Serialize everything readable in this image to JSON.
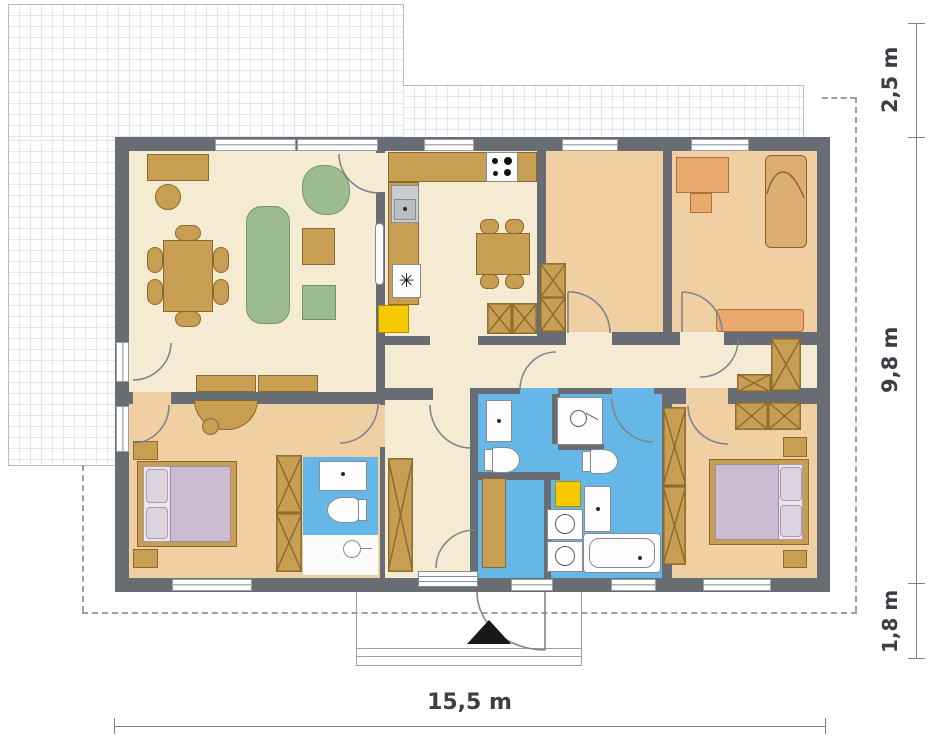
{
  "dimension_labels": {
    "right_top": "2,5 m",
    "right_mid": "9,8 m",
    "right_bottom": "1,8 m",
    "bottom_width": "15,5 m"
  },
  "symbols": {
    "freezer": "✳"
  },
  "palette": {
    "wall": "#686c73",
    "floor_main": "#f4ebd2",
    "floor_bedroom": "#f0cfa2",
    "floor_bath": "#64b7e6",
    "furniture_wood": "#c79e52",
    "sofa_green": "#9cbb90",
    "bed_purple": "#cbbcd3",
    "desk_orange": "#eaa96e",
    "boiler_yellow": "#f6c800",
    "terrace_grid": "#e3e6ec",
    "boundary_dash": "#9aa0a8",
    "dimension_text": "#3a3e45"
  }
}
